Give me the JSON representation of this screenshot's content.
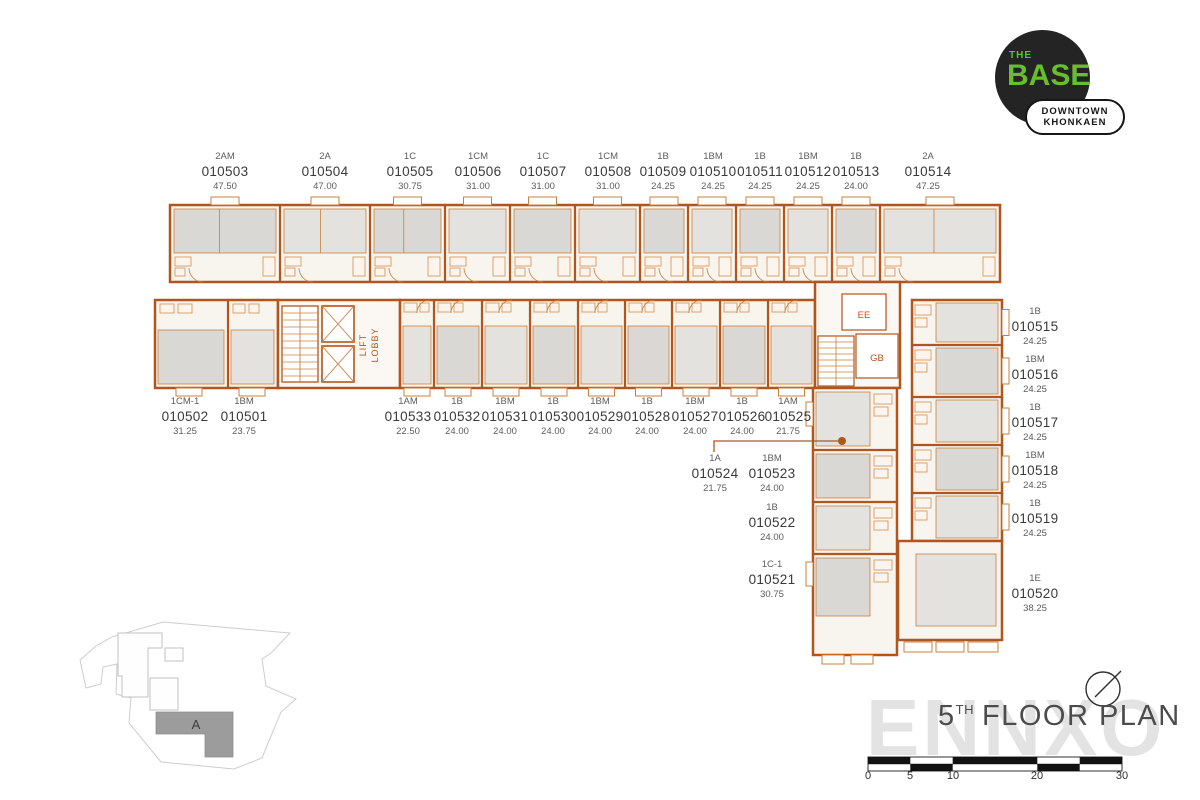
{
  "logo": {
    "the": "THE",
    "base": "BASE",
    "badge_line1": "DOWNTOWN",
    "badge_line2": "KHONKAEN"
  },
  "title": {
    "number": "5",
    "ordinal": "TH",
    "text": "FLOOR PLAN"
  },
  "watermark": {
    "text": "ENNXO"
  },
  "plan_texts": {
    "lift": "LIFT",
    "lobby": "LOBBY",
    "ee": "EE",
    "gb": "GB"
  },
  "site_key": {
    "building_label": "A"
  },
  "scale_bar": {
    "ticks": [
      "0",
      "5",
      "10",
      "20",
      "30"
    ]
  },
  "colors": {
    "wall_orange": "#b2551c",
    "fixture_orange": "#d08648",
    "room_gray": "#e3e2df",
    "logo_green": "#68bf2c",
    "text_dark": "#3a3a3a"
  },
  "units": {
    "top_row": [
      {
        "type": "2AM",
        "no": "010503",
        "area": "47.50"
      },
      {
        "type": "2A",
        "no": "010504",
        "area": "47.00"
      },
      {
        "type": "1C",
        "no": "010505",
        "area": "30.75"
      },
      {
        "type": "1CM",
        "no": "010506",
        "area": "31.00"
      },
      {
        "type": "1C",
        "no": "010507",
        "area": "31.00"
      },
      {
        "type": "1CM",
        "no": "010508",
        "area": "31.00"
      },
      {
        "type": "1B",
        "no": "010509",
        "area": "24.25"
      },
      {
        "type": "1BM",
        "no": "010510",
        "area": "24.25"
      },
      {
        "type": "1B",
        "no": "010511",
        "area": "24.25"
      },
      {
        "type": "1BM",
        "no": "010512",
        "area": "24.25"
      },
      {
        "type": "1B",
        "no": "010513",
        "area": "24.00"
      },
      {
        "type": "2A",
        "no": "010514",
        "area": "47.25"
      }
    ],
    "left_pair": [
      {
        "type": "1CM-1",
        "no": "010502",
        "area": "31.25"
      },
      {
        "type": "1BM",
        "no": "010501",
        "area": "23.75"
      }
    ],
    "middle_row": [
      {
        "type": "1AM",
        "no": "010533",
        "area": "22.50"
      },
      {
        "type": "1B",
        "no": "010532",
        "area": "24.00"
      },
      {
        "type": "1BM",
        "no": "010531",
        "area": "24.00"
      },
      {
        "type": "1B",
        "no": "010530",
        "area": "24.00"
      },
      {
        "type": "1BM",
        "no": "010529",
        "area": "24.00"
      },
      {
        "type": "1B",
        "no": "010528",
        "area": "24.00"
      },
      {
        "type": "1BM",
        "no": "010527",
        "area": "24.00"
      },
      {
        "type": "1B",
        "no": "010526",
        "area": "24.00"
      },
      {
        "type": "1AM",
        "no": "010525",
        "area": "21.75"
      }
    ],
    "right_column": [
      {
        "type": "1B",
        "no": "010515",
        "area": "24.25"
      },
      {
        "type": "1BM",
        "no": "010516",
        "area": "24.25"
      },
      {
        "type": "1B",
        "no": "010517",
        "area": "24.25"
      },
      {
        "type": "1BM",
        "no": "010518",
        "area": "24.25"
      },
      {
        "type": "1B",
        "no": "010519",
        "area": "24.25"
      },
      {
        "type": "1E",
        "no": "010520",
        "area": "38.25"
      }
    ],
    "inner_right": [
      {
        "type": "1A",
        "no": "010524",
        "area": "21.75"
      },
      {
        "type": "1BM",
        "no": "010523",
        "area": "24.00"
      },
      {
        "type": "1B",
        "no": "010522",
        "area": "24.00"
      },
      {
        "type": "1C-1",
        "no": "010521",
        "area": "30.75"
      }
    ]
  }
}
